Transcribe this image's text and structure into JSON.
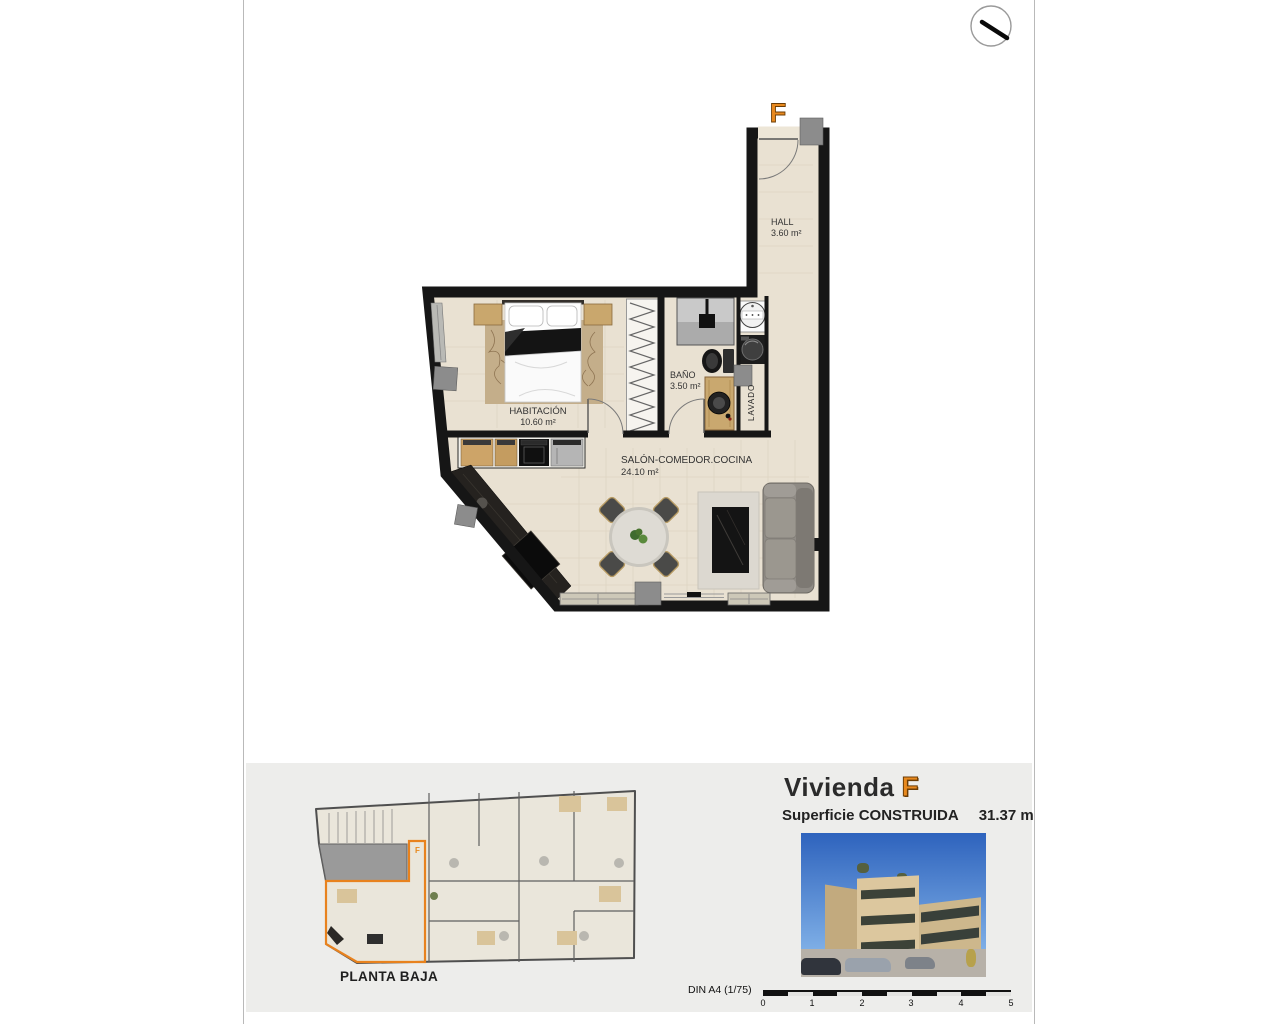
{
  "plan": {
    "unit_letter": "F",
    "rooms": [
      {
        "name": "HALL",
        "area": "3.60 m²"
      },
      {
        "name": "BAÑO",
        "area": "3.50 m²"
      },
      {
        "name": "HABITACIÓN",
        "area": "10.60 m²"
      },
      {
        "name": "SALÓN-COMEDOR.COCINA",
        "area": "24.10 m²"
      }
    ],
    "laundry_label": "LAVADO"
  },
  "footer": {
    "floor_plan_label": "PLANTA BAJA",
    "unit_title": "Vivienda",
    "unit_letter": "F",
    "surface_label": "Superficie CONSTRUIDA",
    "surface_value": "31.37 m²",
    "scale_label": "DIN A4 (1/75)",
    "scale_ticks": [
      "0",
      "1",
      "2",
      "3",
      "4",
      "5"
    ]
  },
  "colors": {
    "accent_orange": "#E8891E",
    "wall_black": "#161616",
    "floor_tan": "#E9E1D2",
    "footer_gray": "#EDEDEB"
  }
}
